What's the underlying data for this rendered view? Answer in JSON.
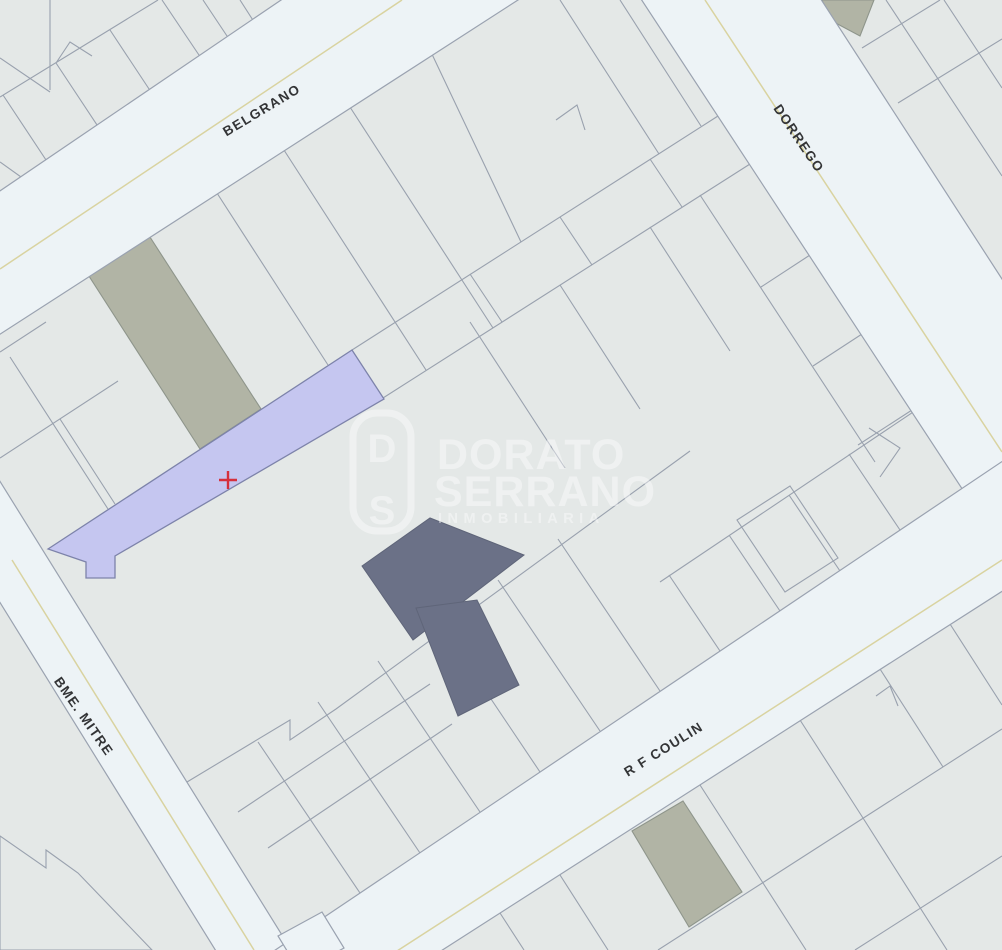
{
  "map": {
    "streets": [
      {
        "name": "BELGRANO"
      },
      {
        "name": "DORREGO"
      },
      {
        "name": "BME. MITRE"
      },
      {
        "name": "R F COULIN"
      }
    ],
    "watermark": {
      "line1": "DORATO",
      "line2": "SERRANO",
      "line3": "INMOBILIARIA",
      "logo_top": "D",
      "logo_bottom": "S"
    },
    "marker": {
      "symbol": "+",
      "color": "#d5303c"
    },
    "colors": {
      "street": "#edf3f6",
      "parcel": "#e4e8e7",
      "parcel_border": "#99a1ae",
      "highlight_parcel": "#c5c6f0",
      "highlight_border": "#7d83aa",
      "dark_parcel": "#6b7187",
      "olive_parcel": "#b1b4a5",
      "centerline": "#d9d3a0",
      "label": "#333436",
      "watermark": "#ffffff"
    }
  }
}
